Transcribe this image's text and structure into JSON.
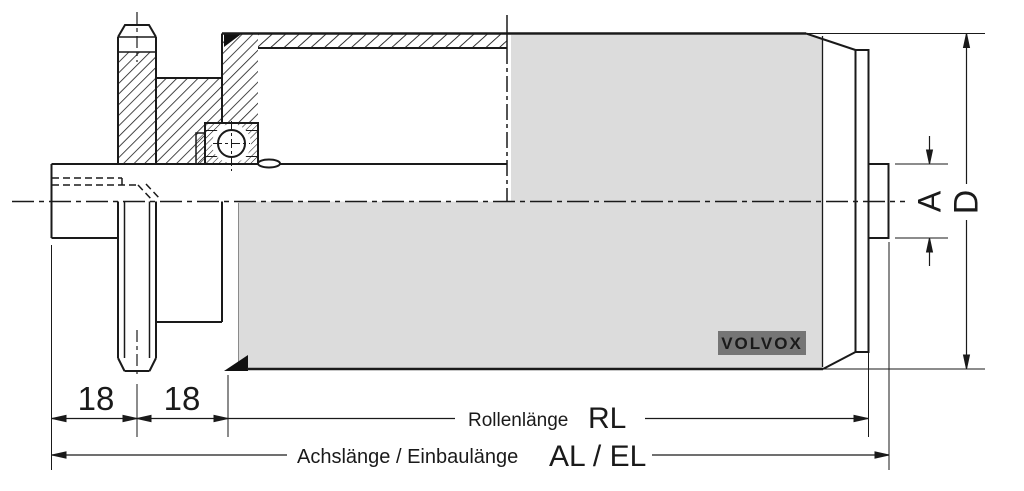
{
  "drawing": {
    "title_context": "conveyor roller cross-section drawing",
    "labels": {
      "dim_left_1": "18",
      "dim_left_2": "18",
      "roller_length_label": "Rollenlänge",
      "roller_length_symbol": "RL",
      "axle_length_label": "Achslänge / Einbaulänge",
      "axle_length_symbol": "AL / EL",
      "axle_diameter_symbol": "A",
      "roller_diameter_symbol": "D",
      "brand": "VOLVOX"
    },
    "colors": {
      "line": "#1a1a1a",
      "tube_fill": "#dcdcdc",
      "badge_bg": "#757575",
      "background": "#ffffff"
    }
  }
}
